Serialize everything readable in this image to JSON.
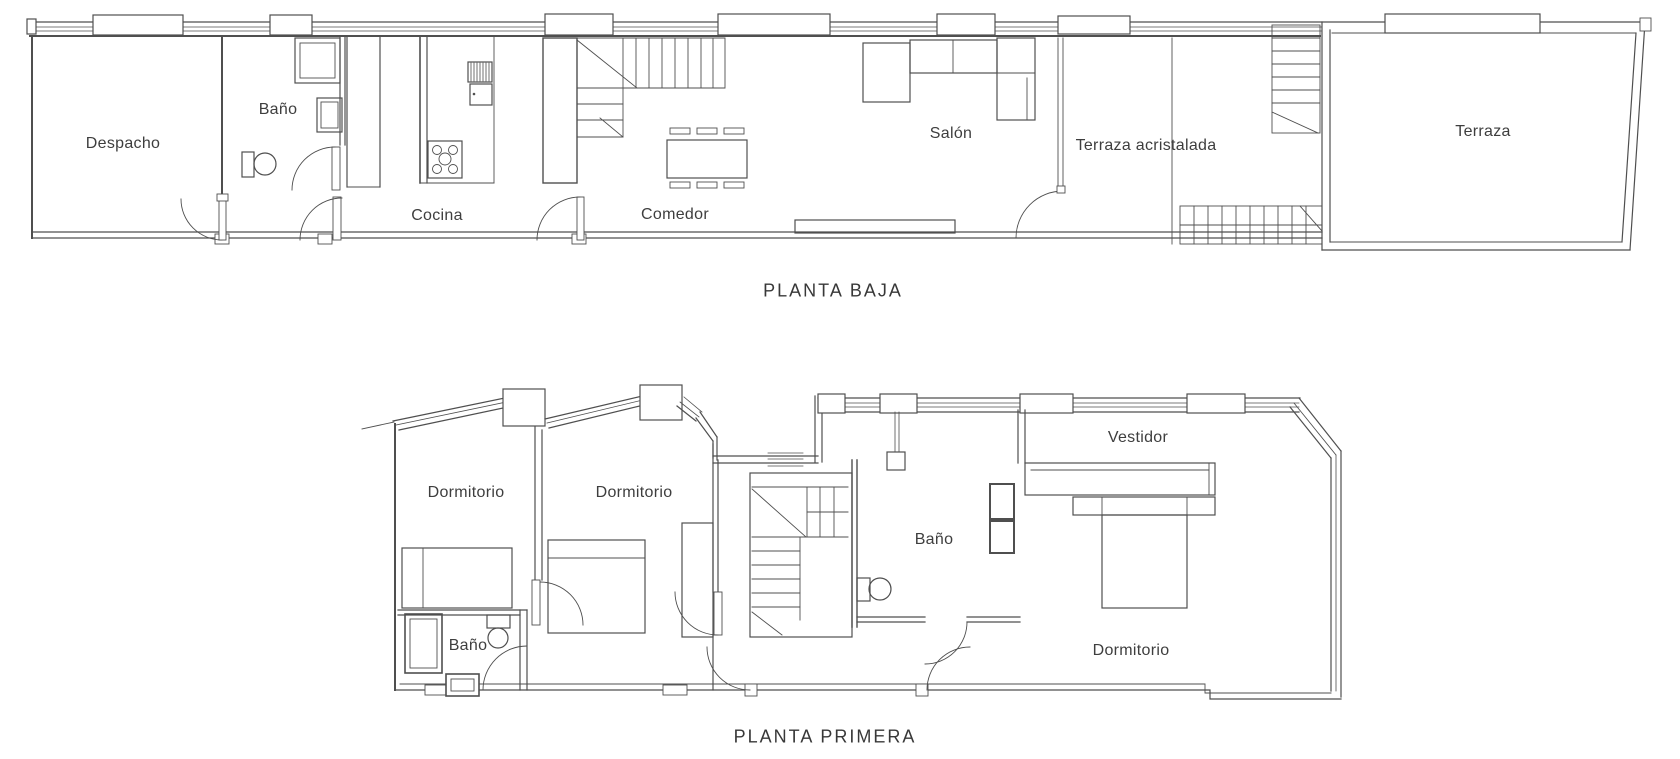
{
  "colors": {
    "background": "#ffffff",
    "line": "#4f4f4f",
    "wall": "#474747",
    "label_text": "#3e3e3e"
  },
  "floors": [
    {
      "title": "PLANTA BAJA",
      "rooms": [
        {
          "label": "Despacho"
        },
        {
          "label": "Baño"
        },
        {
          "label": "Cocina"
        },
        {
          "label": "Comedor"
        },
        {
          "label": "Salón"
        },
        {
          "label": "Terraza acristalada"
        },
        {
          "label": "Terraza"
        }
      ],
      "symbols": [
        "washing-machine",
        "washbasin",
        "toilet",
        "fridge",
        "stove",
        "kitchen-counter",
        "staircase-up",
        "dining-table-six-chairs",
        "corner-sofa",
        "sideboard",
        "staircase-terrace",
        "exterior-steps",
        "door-arc"
      ]
    },
    {
      "title": "PLANTA PRIMERA",
      "rooms": [
        {
          "label": "Dormitorio"
        },
        {
          "label": "Dormitorio"
        },
        {
          "label": "Baño"
        },
        {
          "label": "Vestidor"
        },
        {
          "label": "Baño"
        },
        {
          "label": "Dormitorio"
        }
      ],
      "symbols": [
        "single-bed",
        "single-bed",
        "wardrobe",
        "staircase",
        "shower",
        "toilet",
        "washbasin",
        "ceiling-lamp",
        "storage-cabinets",
        "closet-rail",
        "double-bed",
        "door-arc"
      ]
    }
  ]
}
